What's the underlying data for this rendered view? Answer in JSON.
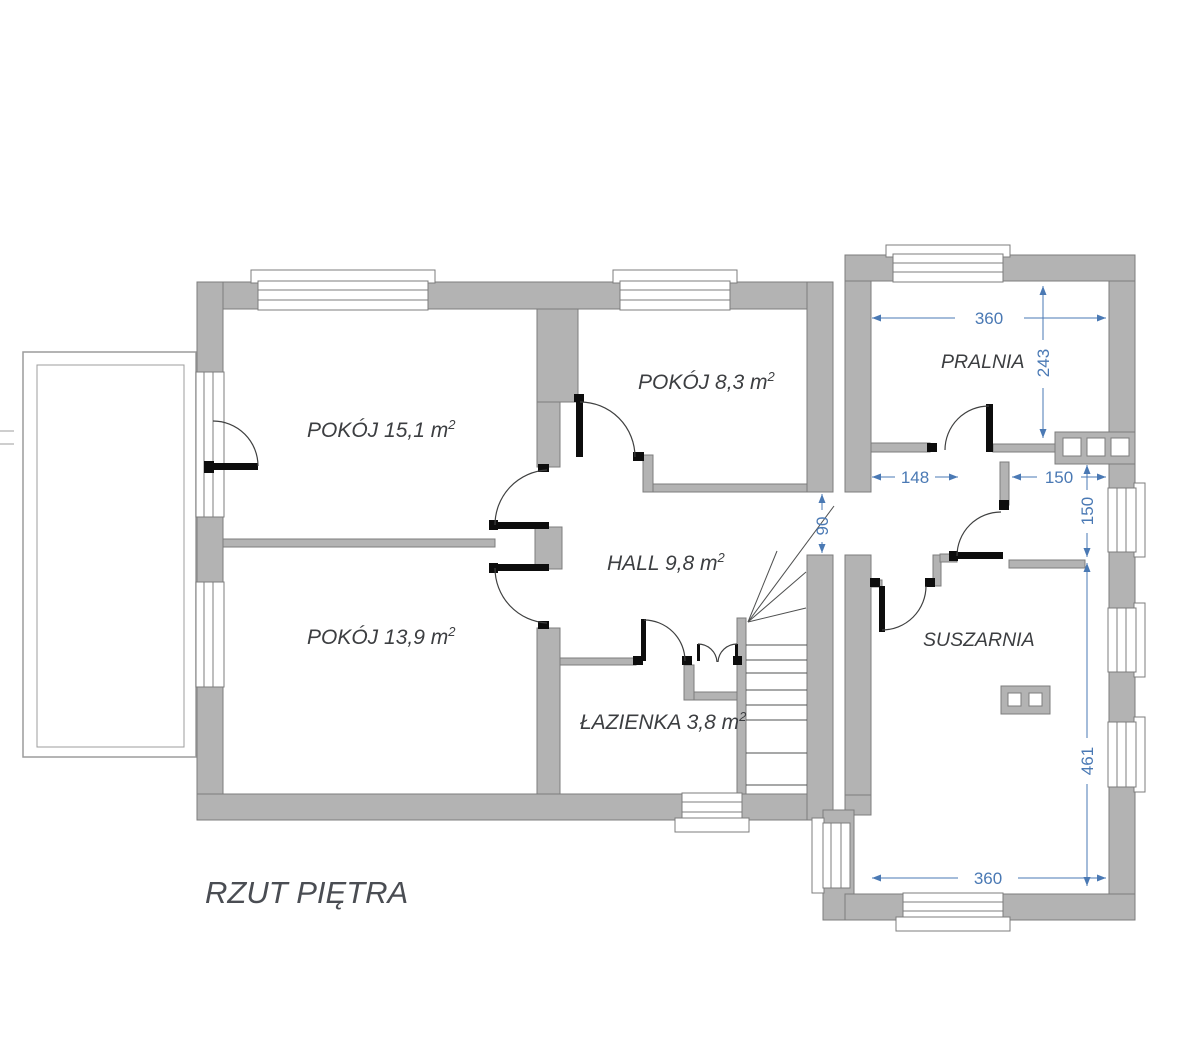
{
  "title": {
    "text": "RZUT PIĘTRA"
  },
  "colors": {
    "wall": "#b3b3b3",
    "wall_outline": "#7c7c7c",
    "door": "#0d0d0d",
    "dimension": "#4a79b4",
    "label": "#3c3e41",
    "title_color": "#4a4d53"
  },
  "rooms": [
    {
      "name": "POKÓJ",
      "area": "15,1",
      "unit": "m2",
      "label": "POKÓJ 15,1 m",
      "sup": "2"
    },
    {
      "name": "POKÓJ",
      "area": "8,3",
      "unit": "m2",
      "label": "POKÓJ 8,3 m",
      "sup": "2"
    },
    {
      "name": "POKÓJ",
      "area": "13,9",
      "unit": "m2",
      "label": "POKÓJ 13,9 m",
      "sup": "2"
    },
    {
      "name": "HALL",
      "area": "9,8",
      "unit": "m2",
      "label": "HALL 9,8 m",
      "sup": "2"
    },
    {
      "name": "ŁAZIENKA",
      "area": "3,8",
      "unit": "m2",
      "label": "ŁAZIENKA 3,8 m",
      "sup": "2"
    },
    {
      "name": "PRALNIA",
      "area": "",
      "unit": "",
      "label": "PRALNIA",
      "sup": ""
    },
    {
      "name": "SUSZARNIA",
      "area": "",
      "unit": "",
      "label": "SUSZARNIA",
      "sup": ""
    }
  ],
  "dimensions": {
    "pralnia_width": "360",
    "pralnia_depth": "243",
    "passage_width": "148",
    "vestibule_width": "150",
    "vestibule_depth": "150",
    "corridor_opening": "90",
    "suszarnia_depth": "461",
    "suszarnia_width": "360"
  }
}
